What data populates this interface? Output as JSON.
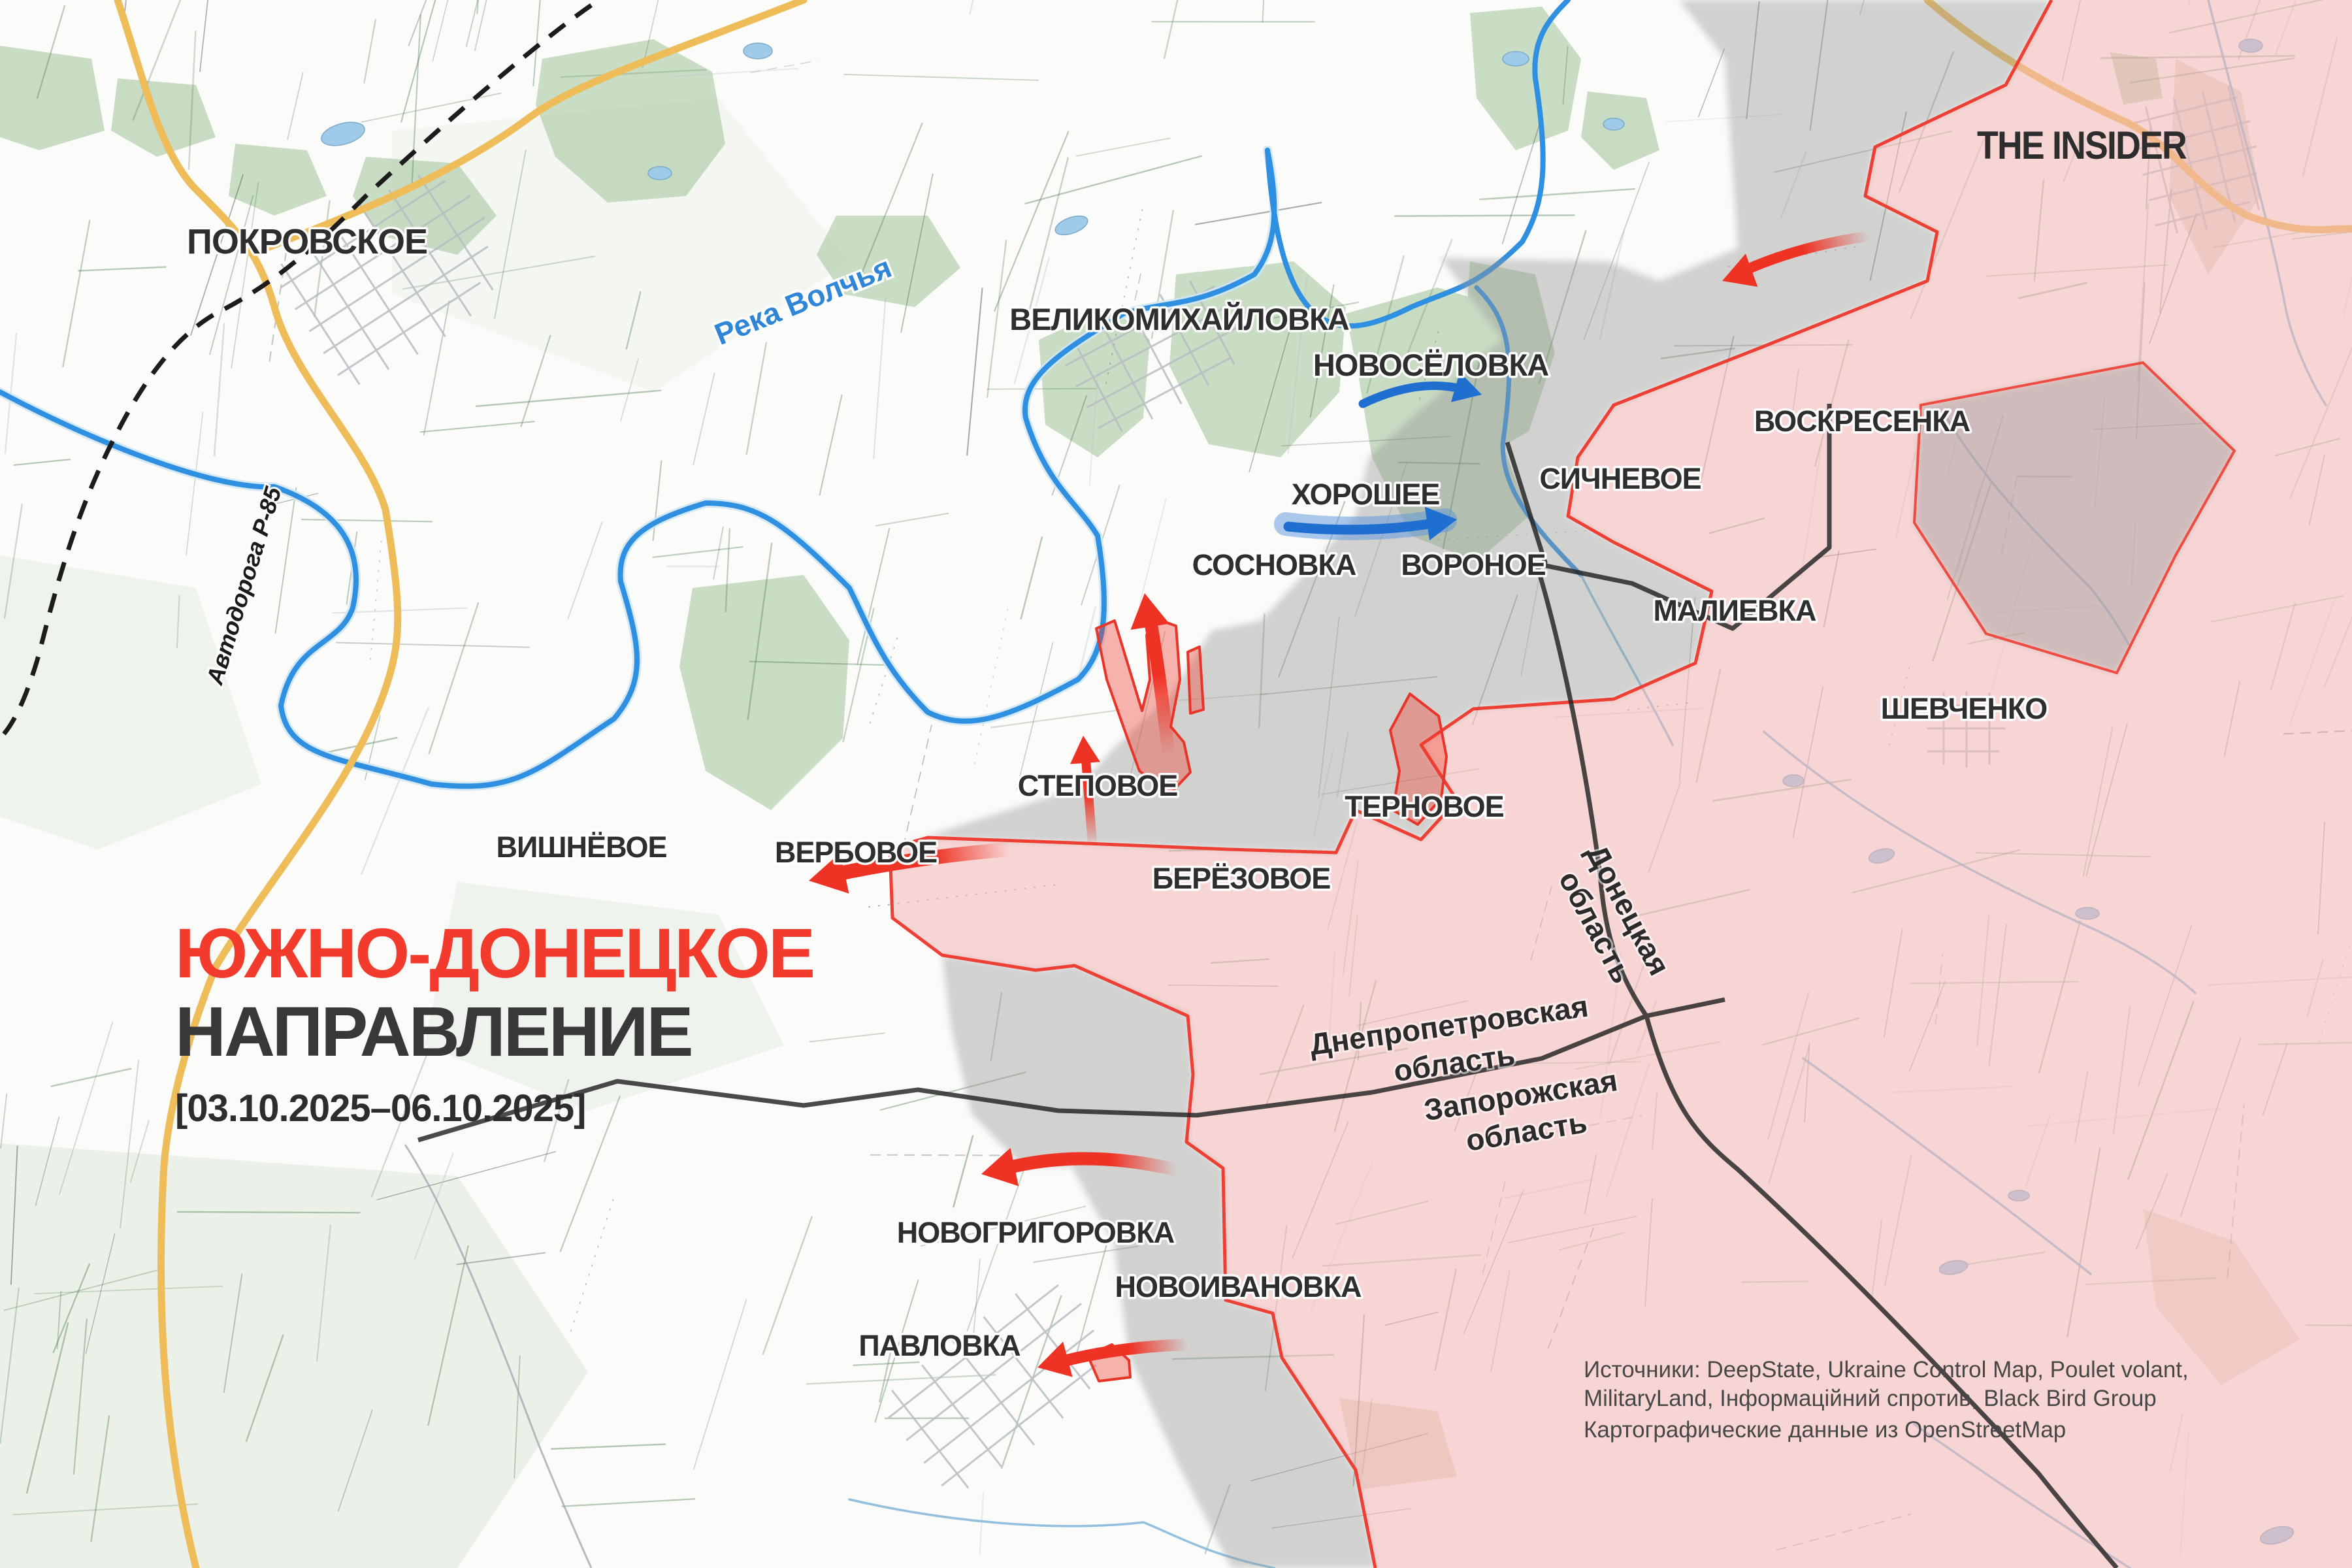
{
  "title": {
    "line1": "ЮЖНО-ДОНЕЦКОЕ",
    "line2": "НАПРАВЛЕНИЕ",
    "date_range": "[03.10.2025–06.10.2025]"
  },
  "branding": {
    "logo": "THE INSIDER"
  },
  "sources": {
    "line1": "Источники: DeepState, Ukraine Control Map, Poulet volant,",
    "line2": "MilitaryLand, Інформаційний спротив, Black Bird Group",
    "line3": "Картографические данные из OpenStreetMap"
  },
  "settlements": [
    {
      "name": "ПОКРОВСКОЕ"
    },
    {
      "name": "ВЕЛИКОМИХАЙЛОВКА"
    },
    {
      "name": "НОВОСЁЛОВКА"
    },
    {
      "name": "СИЧНЕВОЕ"
    },
    {
      "name": "ХОРОШЕЕ"
    },
    {
      "name": "СОСНОВКА"
    },
    {
      "name": "ВОРОНОЕ"
    },
    {
      "name": "ВОСКРЕСЕНКА"
    },
    {
      "name": "МАЛИЕВКА"
    },
    {
      "name": "ШЕВЧЕНКО"
    },
    {
      "name": "СТЕПОВОЕ"
    },
    {
      "name": "ТЕРНОВОЕ"
    },
    {
      "name": "БЕРЁЗОВОЕ"
    },
    {
      "name": "ВЕРБОВОЕ"
    },
    {
      "name": "ВИШНЁВОЕ"
    },
    {
      "name": "НОВОГРИГОРОВКА"
    },
    {
      "name": "НОВОИВАНОВКА"
    },
    {
      "name": "ПАВЛОВКА"
    }
  ],
  "regions": {
    "dnipro_line1": "Днепропетровская",
    "dnipro_line2": "область",
    "zaporozhye_line1": "Запорожская",
    "zaporozhye_line2": "область",
    "donetsk_line1": "Донецкая",
    "donetsk_line2": "область"
  },
  "water": {
    "river_volchya": "Река Волчья"
  },
  "roads": {
    "r85": "Автодорога Р-85"
  },
  "colors": {
    "frontline_red": "#ee3f34",
    "occupied_pink": "#f4b7b5",
    "contested_gray": "#9a9a9a",
    "advance_red": "#ee3325",
    "advance_blue": "#1e6fd0",
    "river_blue": "#2f8fe0",
    "road_orange": "#eebd5a",
    "title_red": "#f23b2d",
    "title_dark": "#383838"
  }
}
